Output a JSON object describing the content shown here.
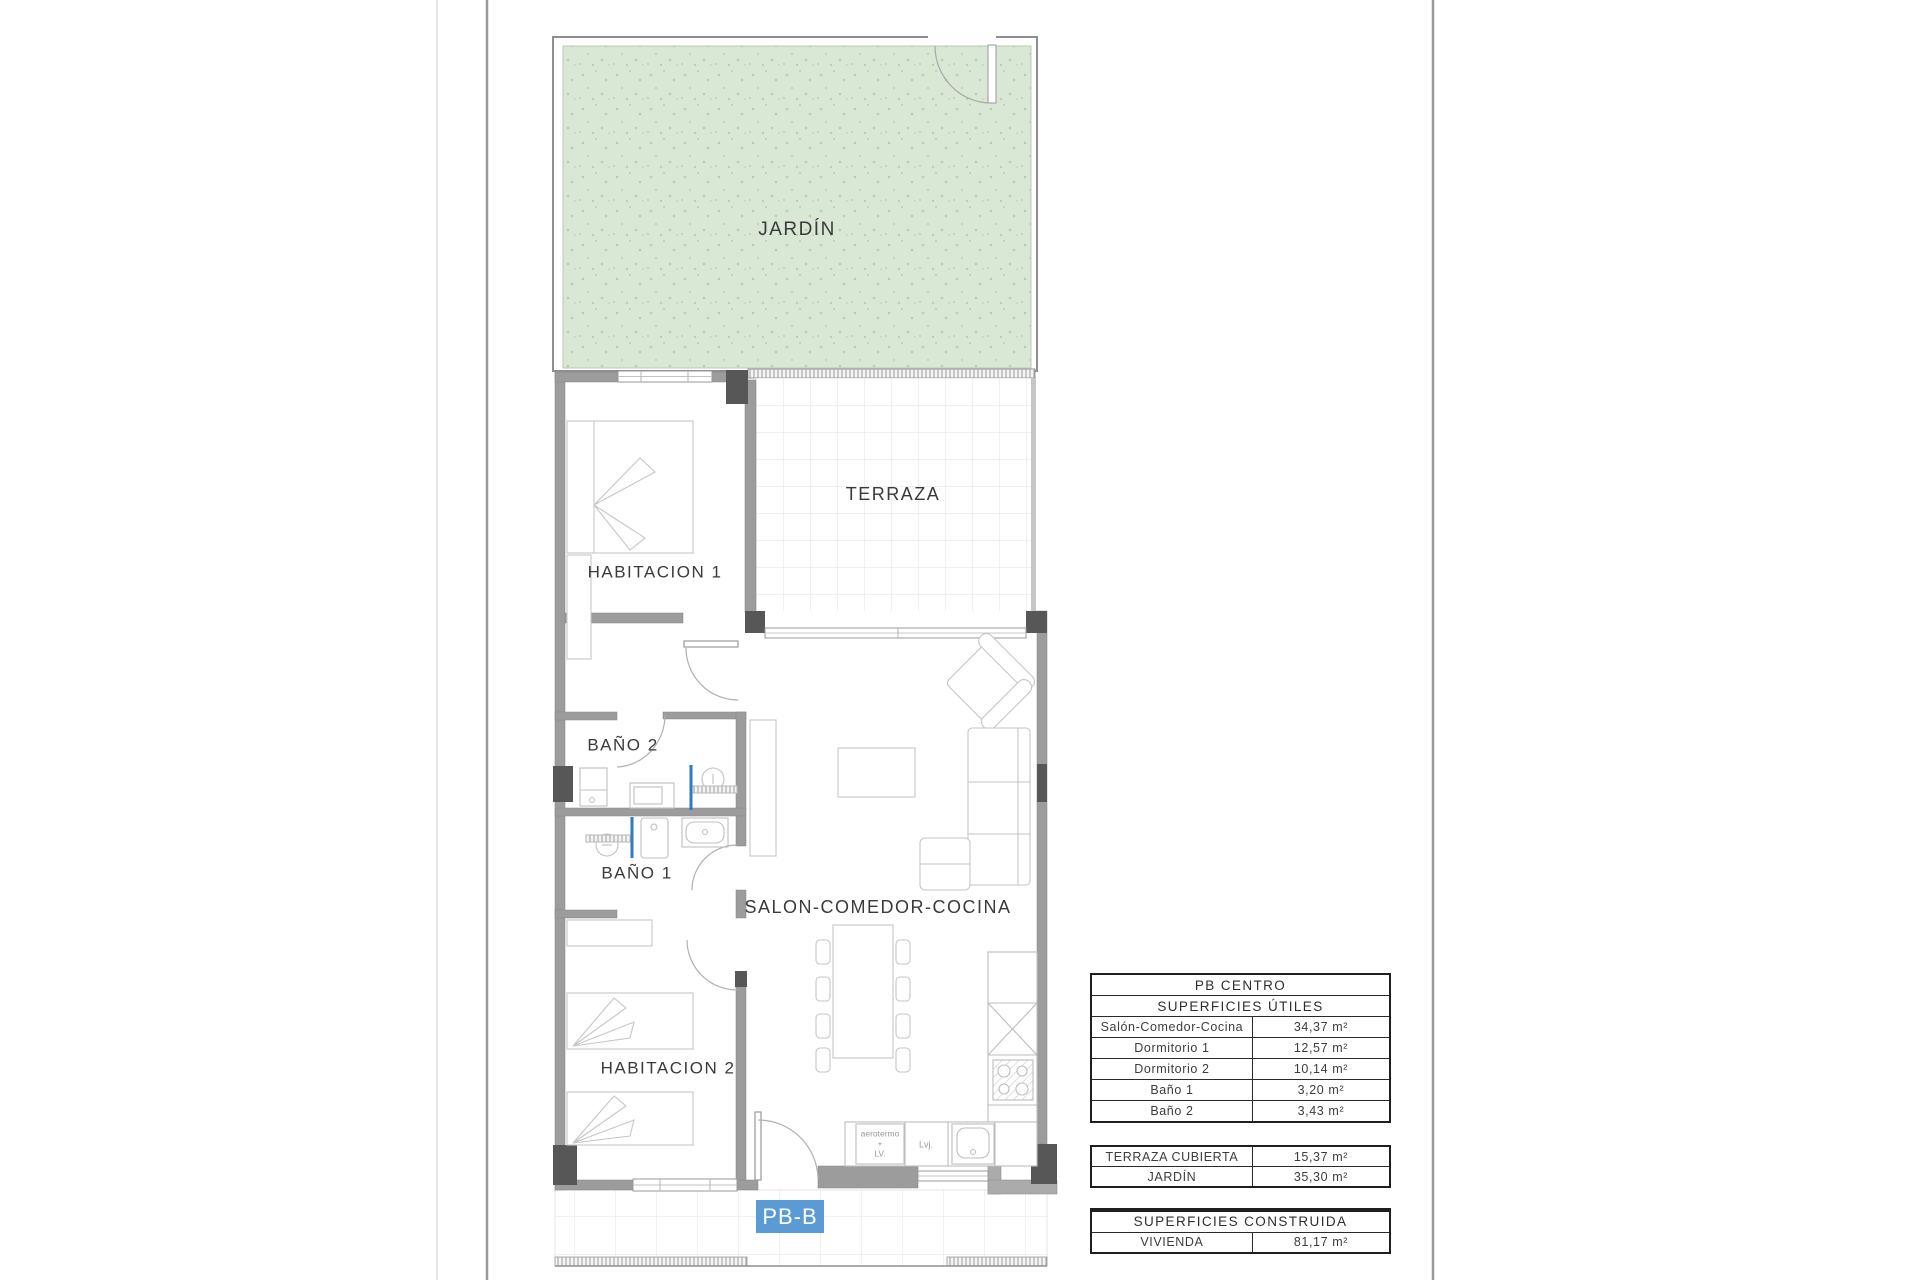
{
  "plan": {
    "sheet_label": "PB-B",
    "rooms": {
      "jardin": "JARDÍN",
      "terraza": "TERRAZA",
      "habitacion1": "HABITACION 1",
      "bano2": "BAÑO 2",
      "bano1": "BAÑO 1",
      "salon": "SALON-COMEDOR-COCINA",
      "habitacion2": "HABITACION 2"
    },
    "kitchen_labels": {
      "aerotermo_line1": "aerotermo",
      "aerotermo_line2": "+",
      "aerotermo_line3": "LV.",
      "dishwasher": "Lvj."
    },
    "colors": {
      "garden_fill": "#d9e8d4",
      "wall": "#9c9c9c",
      "wall_dark": "#575757",
      "label_blue": "#5b9bd5",
      "plumbing_blue": "#2f7ac1"
    }
  },
  "tables": {
    "useful": {
      "title": "PB CENTRO",
      "subtitle": "SUPERFICIES ÚTILES",
      "rows": [
        {
          "label": "Salón-Comedor-Cocina",
          "value": "34,37 m²"
        },
        {
          "label": "Dormitorio 1",
          "value": "12,57 m²"
        },
        {
          "label": "Dormitorio 2",
          "value": "10,14 m²"
        },
        {
          "label": "Baño 1",
          "value": "3,20 m²"
        },
        {
          "label": "Baño 2",
          "value": "3,43 m²"
        }
      ]
    },
    "exterior": {
      "rows": [
        {
          "label": "TERRAZA CUBIERTA",
          "value": "15,37 m²"
        },
        {
          "label": "JARDÍN",
          "value": "35,30 m²"
        }
      ]
    },
    "built": {
      "title": "SUPERFICIES CONSTRUIDA",
      "rows": [
        {
          "label": "VIVIENDA",
          "value": "81,17 m²"
        }
      ]
    }
  }
}
